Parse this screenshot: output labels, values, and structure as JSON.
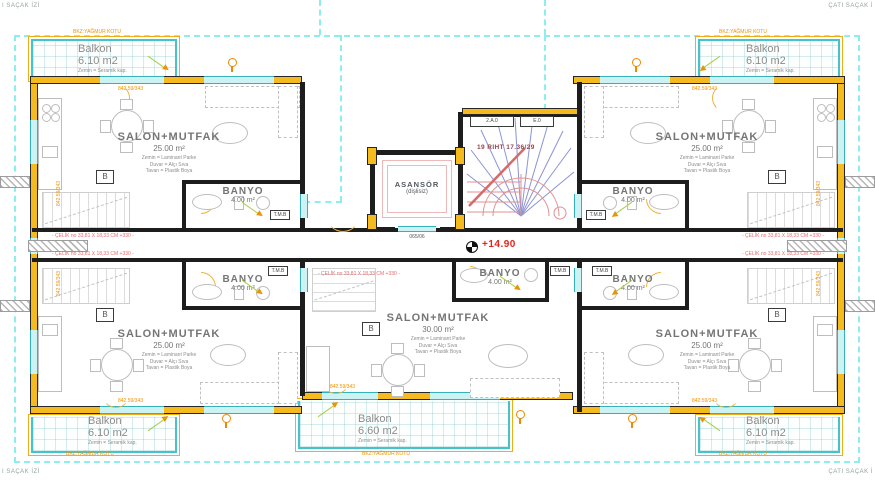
{
  "eave": {
    "tl": "I SAÇAK İZİ",
    "tr": "ÇATI SAÇAK İ",
    "bl": "I SAÇAK İZİ",
    "br": "ÇATI SAÇAK İ"
  },
  "core": {
    "asansor": "ASANSÖR",
    "asansor_sub": "(dişlisiz)",
    "asansor_dim": "065/06",
    "stair_note": "19 RIHT 17.36/29",
    "elevation": "+14.90",
    "door_tag_a": "2.A.0",
    "door_tag_b": "E.0"
  },
  "apartments": [
    {
      "name": "top-left",
      "salon": "SALON+MUTFAK",
      "salon_area": "25.00 m²",
      "note_floor": "Zemin = Laminant Parke",
      "note_wall": "Duvar = Alçı Sıva",
      "note_ceiling": "Tavan = Plastik Boya",
      "balkon": "Balkon",
      "balkon_area": "6.10 m2",
      "balkon_note": "Zemin = Seramik kap.",
      "banyo": "BANYO",
      "banyo_area": "4.00 m²"
    },
    {
      "name": "top-right",
      "salon": "SALON+MUTFAK",
      "salon_area": "25.00 m²",
      "note_floor": "Zemin = Laminant Parke",
      "note_wall": "Duvar = Alçı Sıva",
      "note_ceiling": "Tavan = Plastik Boya",
      "balkon": "Balkon",
      "balkon_area": "6.10 m2",
      "balkon_note": "Zemin = Seramik kap.",
      "banyo": "BANYO",
      "banyo_area": "4.00 m²"
    },
    {
      "name": "bottom-left",
      "salon": "SALON+MUTFAK",
      "salon_area": "25.00 m²",
      "note_floor": "Zemin = Laminant Parke",
      "note_wall": "Duvar = Alçı Sıva",
      "note_ceiling": "Tavan = Plastik Boya",
      "balkon": "Balkon",
      "balkon_area": "6.10 m2",
      "balkon_note": "Zemin = Seramik kap.",
      "banyo": "BANYO",
      "banyo_area": "4.00 m²"
    },
    {
      "name": "bottom-center",
      "salon": "SALON+MUTFAK",
      "salon_area": "30.00 m²",
      "note_floor": "Zemin = Laminant Parke",
      "note_wall": "Duvar = Alçı Sıva",
      "note_ceiling": "Tavan = Plastik Boya",
      "balkon": "Balkon",
      "balkon_area": "6.60 m2",
      "balkon_note": "Zemin = Seramik kap.",
      "banyo": "BANYO",
      "banyo_area": "4.00 m²"
    },
    {
      "name": "bottom-right",
      "salon": "SALON+MUTFAK",
      "salon_area": "25.00 m²",
      "note_floor": "Zemin = Laminant Parke",
      "note_wall": "Duvar = Alçı Sıva",
      "note_ceiling": "Tavan = Plastik Boya",
      "balkon": "Balkon",
      "balkon_area": "6.10 m2",
      "balkon_note": "Zemin = Seramik kap.",
      "banyo": "BANYO",
      "banyo_area": "4.00 m²"
    }
  ],
  "tags": {
    "tmb": "T.M.B",
    "b": "B"
  },
  "annotations": {
    "celik": "- ÇELİK no 33,81 X 18,33 CM +330 -",
    "yagmur": "BKZ:YAĞMUR KOTU",
    "windim": "842.59/343"
  },
  "colors": {
    "wall_yellow": "#f5ba1e",
    "eave_cyan": "#8deef0",
    "annotation_orange": "#f29200",
    "stair_red": "#e08888",
    "stair_blue": "#8a93d6",
    "elevation_red": "#e3241d"
  }
}
